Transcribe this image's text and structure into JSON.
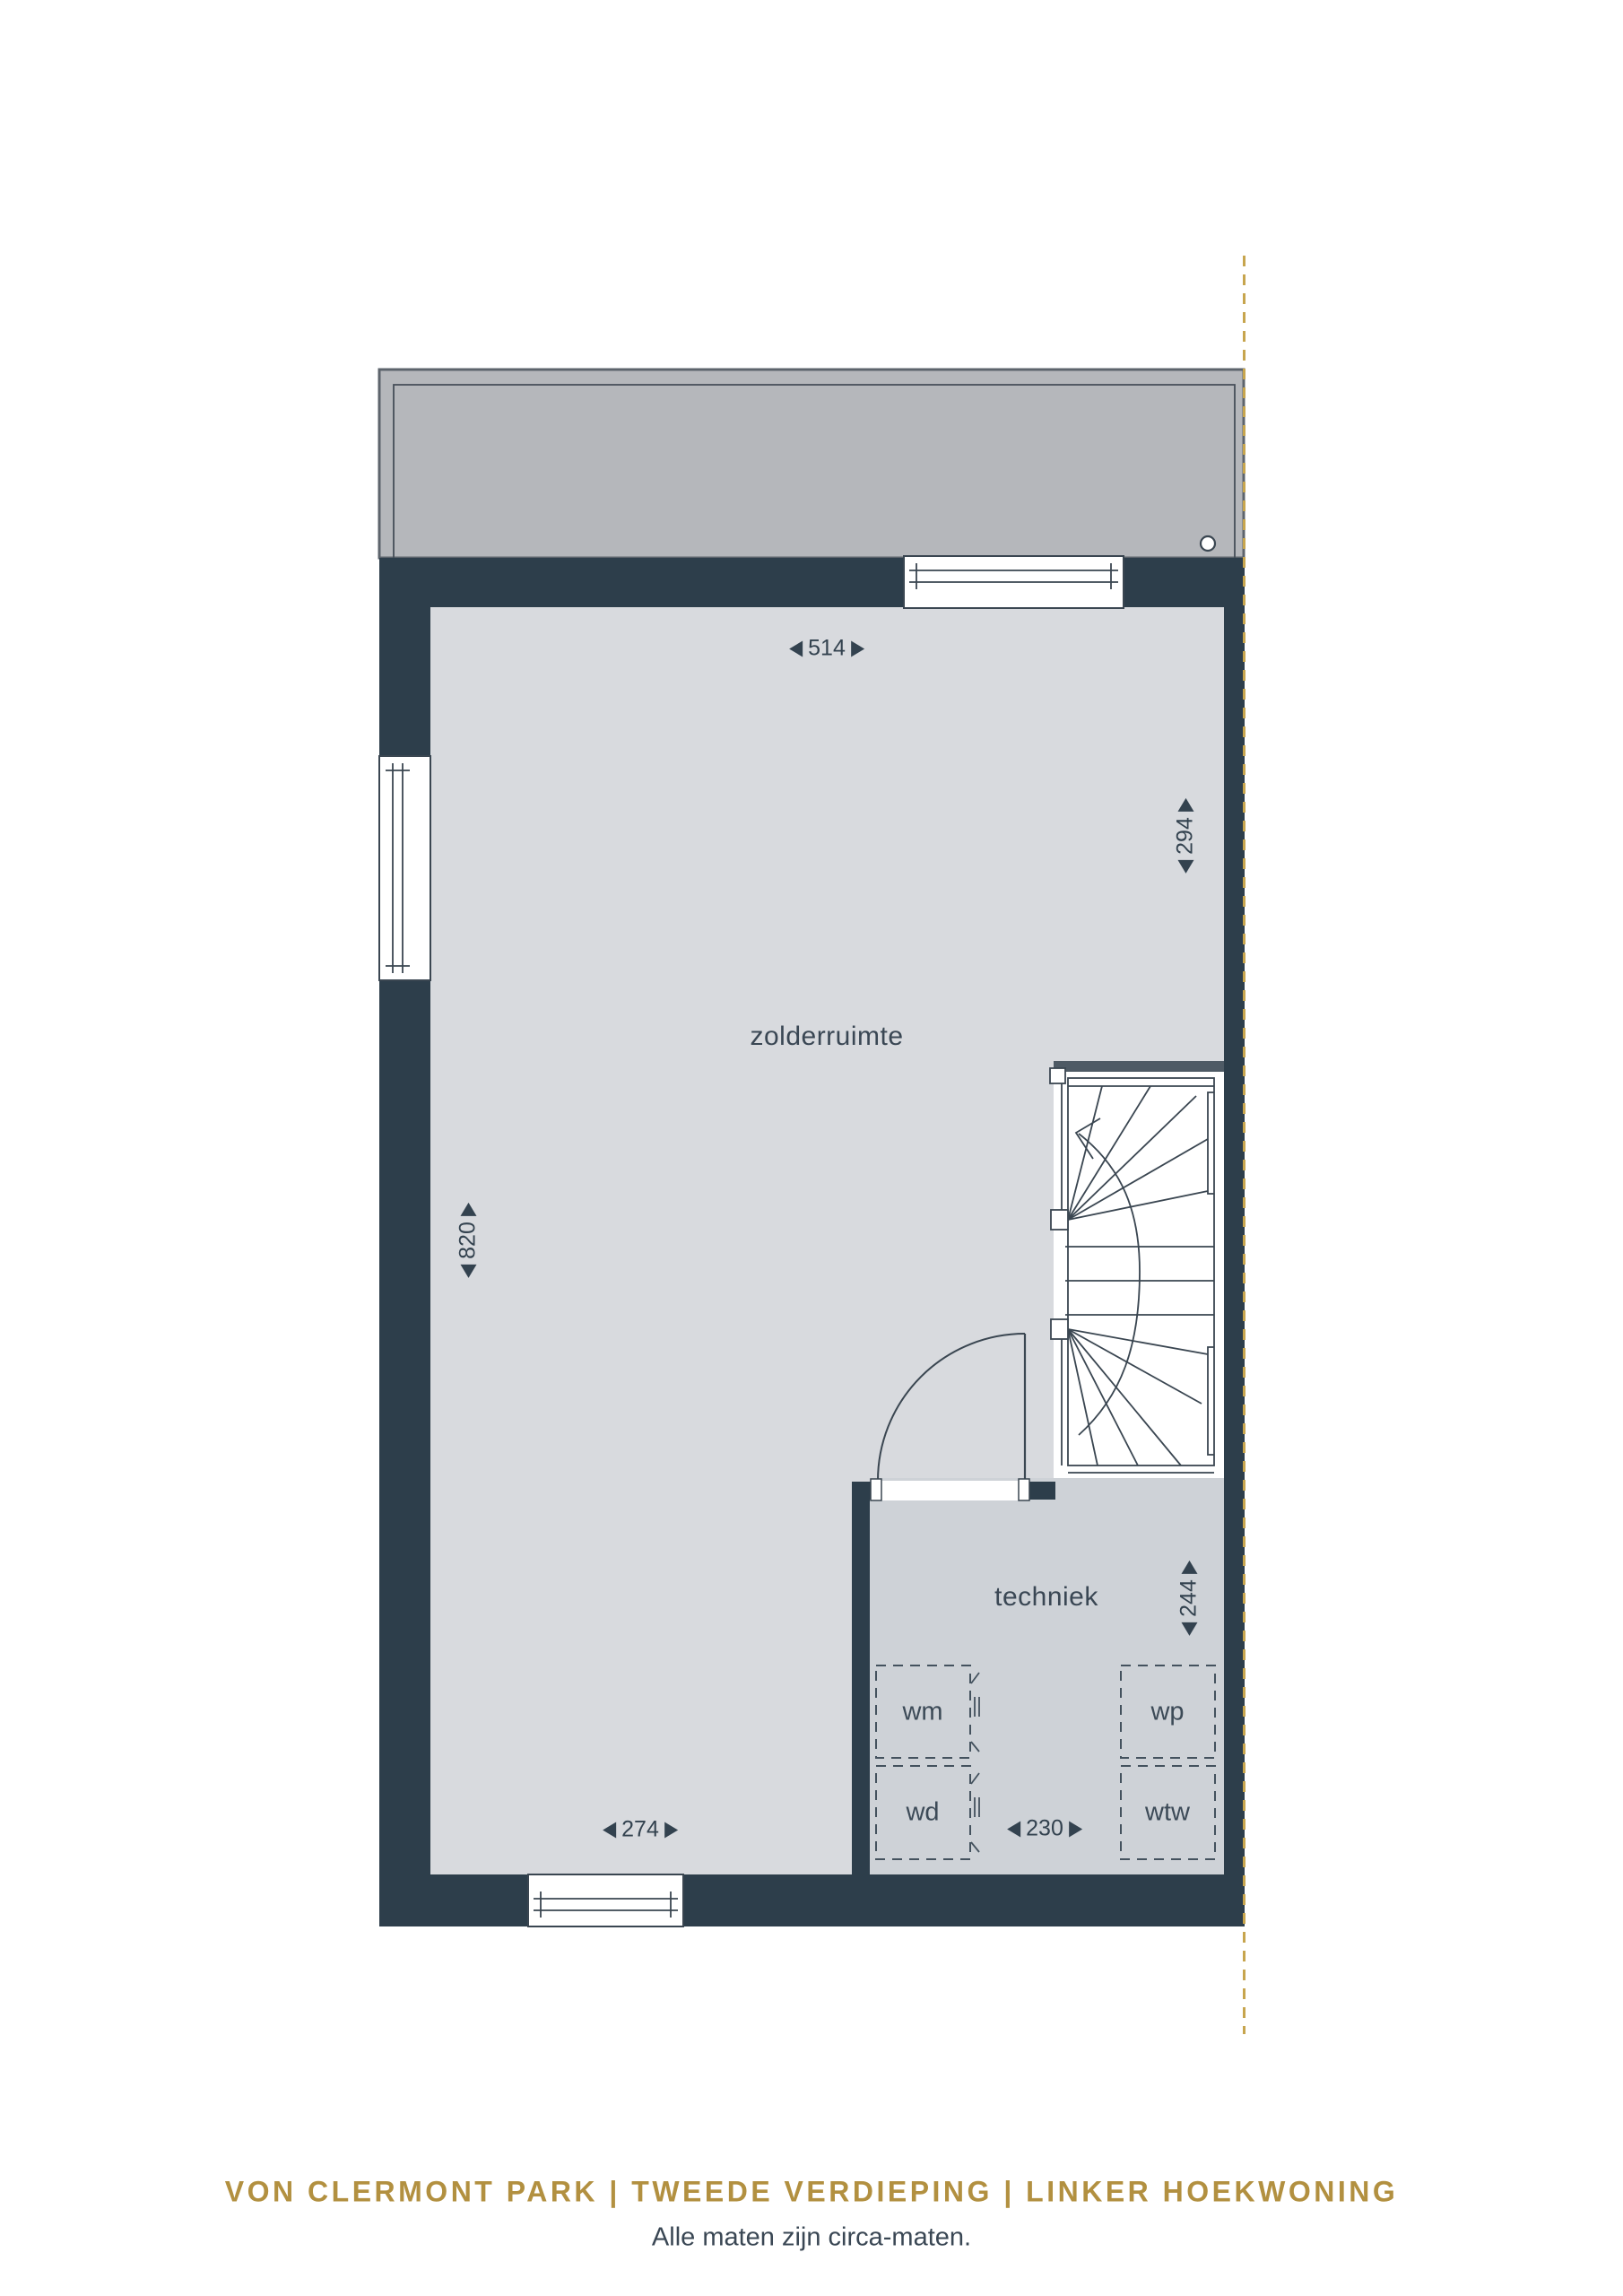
{
  "plan": {
    "rooms": [
      {
        "name": "zolderruimte"
      },
      {
        "name": "techniek"
      }
    ],
    "appliances": [
      {
        "code": "wm"
      },
      {
        "code": "wd"
      },
      {
        "code": "wp"
      },
      {
        "code": "wtw"
      }
    ],
    "measurements": {
      "zolder_width_top": "514",
      "zolder_height_right": "294",
      "zolder_height_left": "820",
      "zolder_width_bottom": "274",
      "techniek_height": "244",
      "techniek_width": "230"
    },
    "colors": {
      "wall": "#2d3e4b",
      "floor_zolder": "#d8dade",
      "floor_techniek": "#ced2d7",
      "roof": "#b5b7bb",
      "stair_lines": "#3a4651",
      "accent_gold": "#b29040",
      "boundary_dash": "#c7a54e",
      "label_text": "#33424f"
    },
    "icons": {
      "arrow_left": "solid left triangle",
      "arrow_right": "solid right triangle",
      "roof_vent": "small outlined circle",
      "party_wall_boundary": "vertical gold dashed line"
    }
  },
  "footer": {
    "title": "VON CLERMONT PARK | TWEEDE VERDIEPING | LINKER HOEKWONING",
    "note": "Alle maten zijn circa-maten."
  }
}
